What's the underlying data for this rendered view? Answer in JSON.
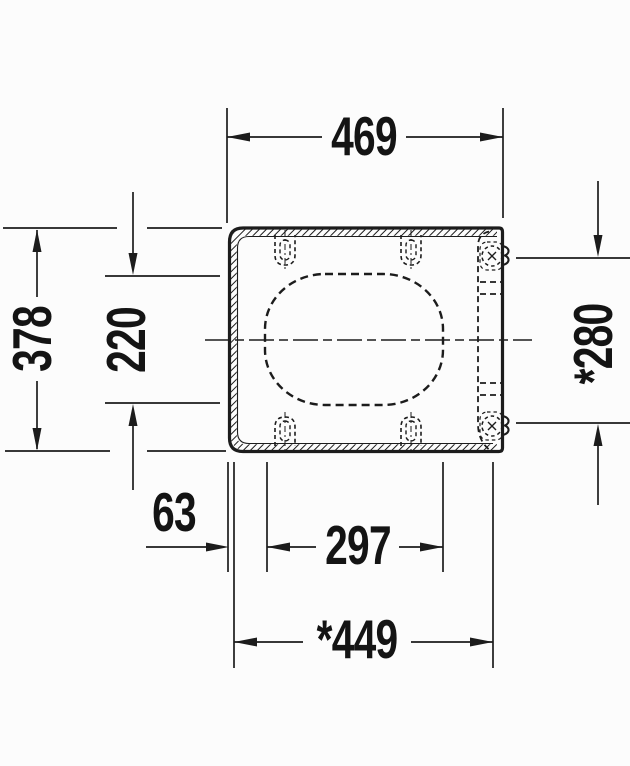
{
  "meta": {
    "type": "technical-dimension-drawing",
    "subject": "Toilet seat and cover, plan view with hinges and mounting slots"
  },
  "colors": {
    "line": "#1c1c1c",
    "background": "#fcfcfc"
  },
  "dims": {
    "width_top": "469",
    "depth_overall": "378",
    "opening_depth": "220",
    "hinge_distance": "*280",
    "edge_offset": "63",
    "opening_width": "297",
    "width_lid": "*449"
  }
}
